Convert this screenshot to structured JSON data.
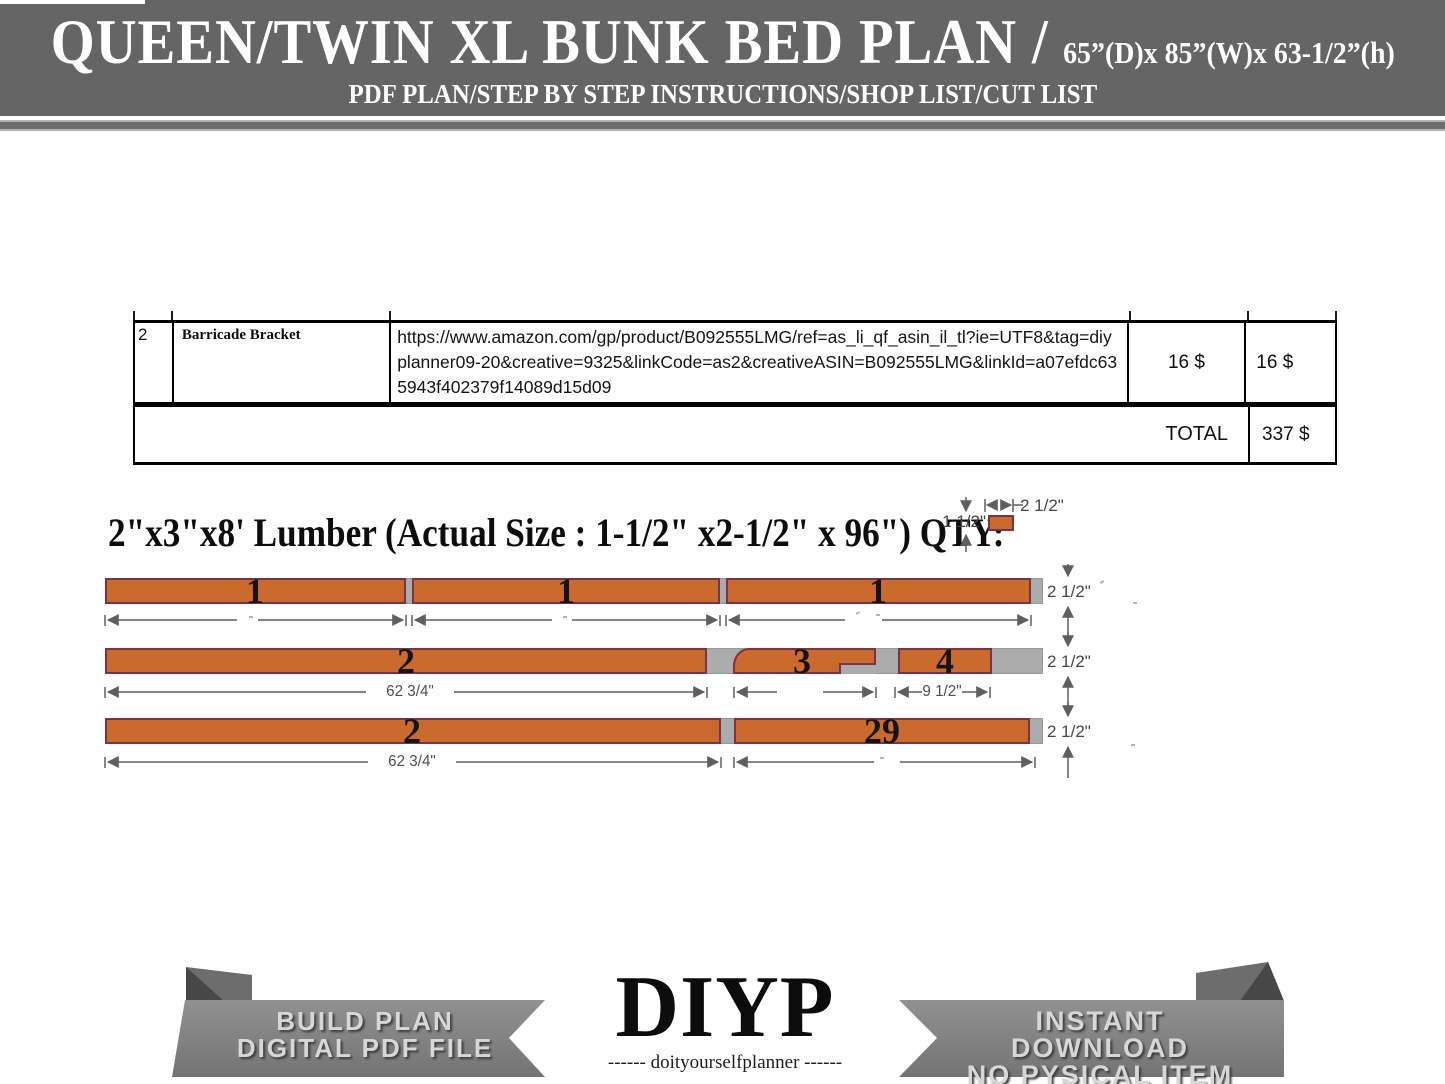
{
  "header": {
    "title": "QUEEN/TWIN XL BUNK BED PLAN /",
    "size": "65”(D)x 85”(W)x 63-1/2”(h)",
    "subtitle": "PDF PLAN/STEP BY STEP INSTRUCTIONS/SHOP LIST/CUT LIST"
  },
  "shop_table": {
    "row": {
      "index": "2",
      "item": "Barricade Bracket",
      "link": "https://www.amazon.com/gp/product/B092555LMG/ref=as_li_qf_asin_il_tl?ie=UTF8&tag=diyplanner09-20&creative=9325&linkCode=as2&creativeASIN=B092555LMG&linkId=a07efdc635943f402379f14089d15d09",
      "unit_price": "16 $",
      "total_price": "16 $"
    },
    "total_label": "TOTAL",
    "total_value": "337 $"
  },
  "lumber": {
    "heading": "2\"x3\"x8' Lumber (Actual Size : 1-1/2\" x2-1/2\" x 96\") QTY:",
    "legend": {
      "thickness": "1 1/2\"",
      "width": "2 1/2\""
    },
    "board_height_label": "2 1/2\"",
    "rows": [
      {
        "pieces": [
          "1",
          "1",
          "1"
        ]
      },
      {
        "pieces": [
          "2",
          "3",
          "4"
        ],
        "dim1": "62 3/4\"",
        "dim2": "9 1/2\""
      },
      {
        "pieces": [
          "2",
          "29"
        ],
        "dim1": "62 3/4\""
      }
    ]
  },
  "footer": {
    "ribbon_left": {
      "line1": "BUILD PLAN",
      "line2": "DIGITAL PDF FILE"
    },
    "logo": {
      "name": "DIYP",
      "tagline": "------ doityourselfplanner ------"
    },
    "ribbon_right": {
      "line1": "INSTANT DOWNLOAD",
      "line2": "NO PYSICAL ITEM"
    }
  },
  "colors": {
    "banner": "#656565",
    "lumber_fill": "#cb6a2d",
    "lumber_border": "#7a3248",
    "stock_gray": "#ababab"
  }
}
